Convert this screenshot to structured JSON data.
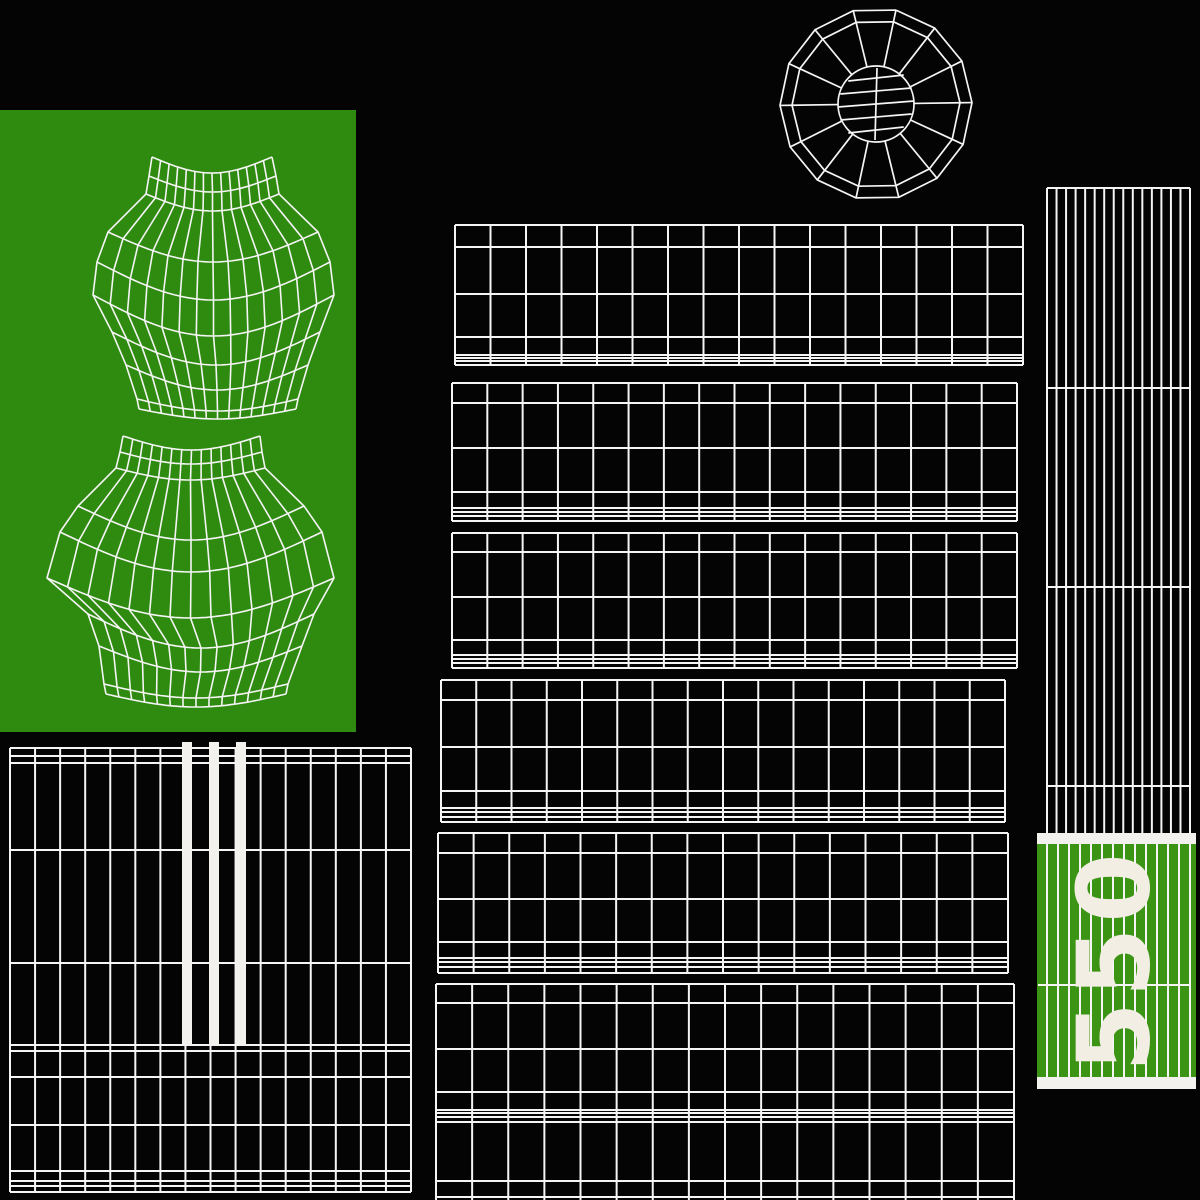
{
  "labels": {
    "size_label": "550"
  },
  "colors": {
    "background": "#040404",
    "line": "#f5f5f5",
    "panelGreen": "#2f8a10",
    "blockGreen": "#3c9415",
    "bandWhite": "#f2f1ee",
    "labelWhite": "#f2eee3"
  },
  "canvas": {
    "width": 1200,
    "height": 1200
  },
  "pieces": [
    {
      "name": "green-panel",
      "type": "rect",
      "x": 0,
      "y": 110,
      "w": 356,
      "h": 622,
      "fill": "panelGreen"
    },
    {
      "name": "torso-top-mesh",
      "type": "mesh",
      "cols": 14,
      "stroke": "line",
      "lw": 1.6,
      "rows": [
        [
          152,
          272,
          157,
          173
        ],
        [
          149,
          276,
          176,
          192
        ],
        [
          146,
          279,
          194,
          211
        ],
        [
          108,
          318,
          232,
          262
        ],
        [
          97,
          330,
          262,
          300
        ],
        [
          93,
          334,
          295,
          336
        ],
        [
          112,
          320,
          332,
          365
        ],
        [
          126,
          308,
          365,
          390
        ],
        [
          137,
          298,
          399,
          411
        ],
        [
          139,
          296,
          409,
          419
        ]
      ]
    },
    {
      "name": "torso-bottom-mesh",
      "type": "mesh",
      "cols": 14,
      "stroke": "line",
      "lw": 1.6,
      "rows": [
        [
          123,
          260,
          436,
          450
        ],
        [
          120,
          262,
          452,
          464
        ],
        [
          116,
          265,
          468,
          480
        ],
        [
          78,
          304,
          506,
          540
        ],
        [
          60,
          322,
          532,
          572
        ],
        [
          47,
          334,
          578,
          618
        ],
        [
          88,
          314,
          614,
          648
        ],
        [
          99,
          302,
          646,
          672
        ],
        [
          104,
          288,
          684,
          698
        ],
        [
          106,
          286,
          694,
          707
        ]
      ]
    },
    {
      "name": "wheel-wireframe",
      "type": "wheel",
      "cx": 876,
      "cy": 104,
      "rOuter": 96,
      "rInner": 84,
      "rHub": 38,
      "segs": 14,
      "angle0": -78,
      "chords": [
        -26,
        -13,
        0,
        13,
        26
      ],
      "lw": 1.7
    },
    {
      "name": "tread-strip-1",
      "type": "tread",
      "x": 455,
      "x2": 1023,
      "cols": 16,
      "rows": [
        225,
        247,
        294,
        337,
        355,
        358,
        361,
        365
      ]
    },
    {
      "name": "tread-strip-2",
      "type": "tread",
      "x": 452,
      "x2": 1017,
      "cols": 16,
      "rows": [
        383,
        403,
        448,
        492,
        508,
        512,
        516,
        521
      ]
    },
    {
      "name": "tread-strip-3",
      "type": "tread",
      "x": 452,
      "x2": 1017,
      "cols": 16,
      "rows": [
        533,
        552,
        597,
        640,
        655,
        659,
        663,
        668
      ]
    },
    {
      "name": "tread-strip-4",
      "type": "tread",
      "x": 441,
      "x2": 1005,
      "cols": 16,
      "rows": [
        680,
        700,
        747,
        791,
        808,
        812,
        817,
        822
      ]
    },
    {
      "name": "tread-strip-5",
      "type": "tread",
      "x": 438,
      "x2": 1008,
      "cols": 16,
      "rows": [
        833,
        853,
        899,
        942,
        958,
        962,
        967,
        973
      ]
    },
    {
      "name": "tread-strip-6",
      "type": "tread",
      "x": 436,
      "x2": 1014,
      "cols": 16,
      "rows": [
        984,
        1003,
        1049,
        1092,
        1110,
        1113,
        1117,
        1122
      ]
    },
    {
      "name": "tread-strip-7",
      "type": "tread",
      "x": 436,
      "x2": 1014,
      "cols": 16,
      "rows": [
        1122,
        1181,
        1197
      ],
      "vbottom": 1206
    },
    {
      "name": "sidewall-strip",
      "type": "vgrid",
      "x": 1047,
      "x2": 1190,
      "y": 188,
      "y2": 833,
      "lines": 16,
      "hlines": [
        188,
        388,
        587,
        786
      ]
    },
    {
      "name": "grid-upper",
      "type": "tread",
      "x": 10,
      "x2": 411,
      "cols": 16,
      "rows": [
        748,
        756,
        763,
        850,
        963,
        1045
      ]
    },
    {
      "name": "grid-lower",
      "type": "tread",
      "x": 10,
      "x2": 411,
      "cols": 16,
      "rows": [
        1045,
        1051,
        1077,
        1125,
        1171,
        1181,
        1186,
        1192
      ]
    },
    {
      "name": "white-bars",
      "type": "bars",
      "fill": "bandWhite",
      "items": [
        {
          "x": 182,
          "y": 742,
          "w": 10,
          "h": 303
        },
        {
          "x": 209,
          "y": 742,
          "w": 10,
          "h": 303
        },
        {
          "x": 236,
          "y": 742,
          "w": 10,
          "h": 303
        }
      ]
    },
    {
      "name": "size-block",
      "type": "rect",
      "x": 1037,
      "y": 833,
      "w": 159,
      "h": 256,
      "fill": "blockGreen"
    },
    {
      "name": "size-block-top-band",
      "type": "rect",
      "x": 1037,
      "y": 833,
      "w": 159,
      "h": 11,
      "fill": "bandWhite"
    },
    {
      "name": "size-block-bottom-band",
      "type": "rect",
      "x": 1037,
      "y": 1077,
      "w": 159,
      "h": 12,
      "fill": "bandWhite"
    },
    {
      "name": "size-block-ribs",
      "type": "vgrid",
      "x": 1047,
      "x2": 1190,
      "y": 844,
      "y2": 1077,
      "lines": 14,
      "hlines": [
        985
      ],
      "hx1": 1038,
      "hx2": 1190
    },
    {
      "name": "size-label",
      "type": "label",
      "x": 1114,
      "y": 960,
      "size": 100,
      "rotate": -90,
      "spacing": 5,
      "fill": "labelWhite",
      "bind": "labels.size_label"
    }
  ]
}
